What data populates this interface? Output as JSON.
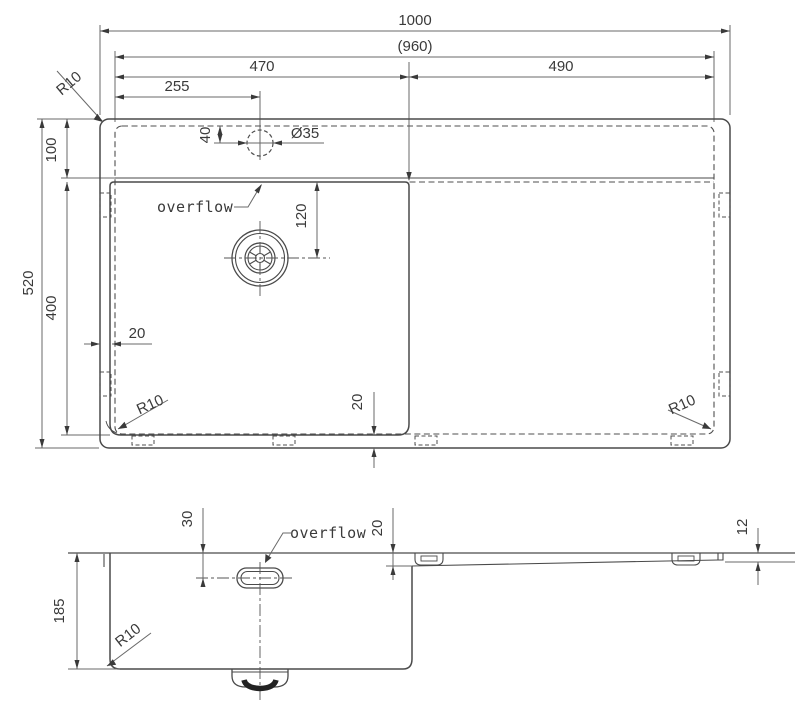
{
  "drawing_type": "sink technical drawing",
  "colors": {
    "background": "#ffffff",
    "object_line": "#4a4a4a",
    "dimension_line": "#6a6a6a",
    "text": "#3a3a3a"
  },
  "top_view": {
    "dims": {
      "overall_width": "1000",
      "inner_width": "(960)",
      "bowl_width": "470",
      "drainboard_width": "490",
      "tap_hole_offset": "255",
      "overall_depth": "520",
      "deck_depth": "100",
      "bowl_depth": "400",
      "tap_hole_diameter": "Ø35",
      "tap_hole_inset": "40",
      "drain_offset": "120",
      "rim_left": "20",
      "rim_bottom": "20",
      "corner_radius_top_left": "R10",
      "corner_radius_bowl": "R10",
      "corner_radius_drainboard": "R10"
    },
    "overflow_label": "overflow"
  },
  "side_view": {
    "dims": {
      "bowl_height": "185",
      "overflow_below_rim": "30",
      "drop_at_bowl": "20",
      "drop_at_end": "12",
      "corner_radius": "R10"
    },
    "overflow_label": "overflow"
  }
}
